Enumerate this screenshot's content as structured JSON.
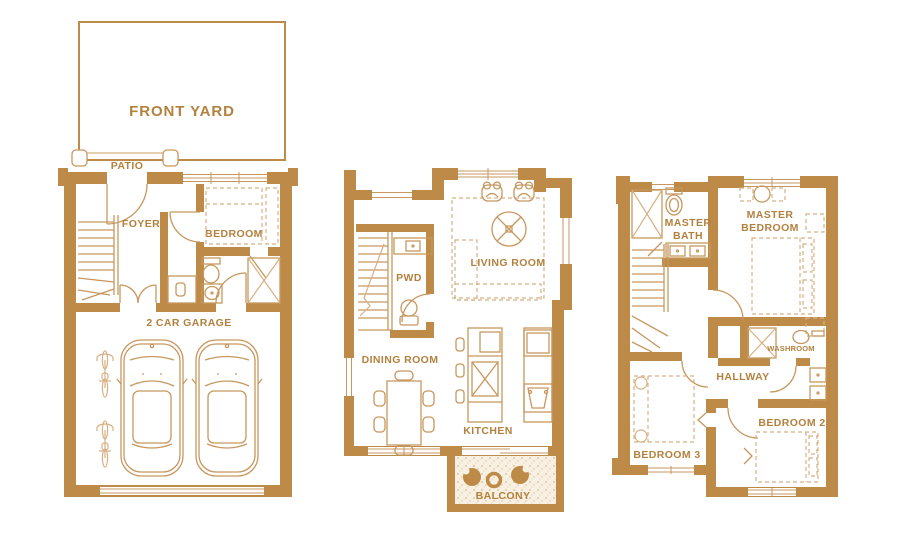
{
  "palette": {
    "wall": "#BE8A48",
    "fixture_line": "#C6975E",
    "furniture_light": "#D7B084",
    "label_text": "#B3813E",
    "balcony_fill": "#F8F1E3",
    "background": "#FFFFFF"
  },
  "plans": [
    {
      "id": "garage-floor",
      "labels": {
        "front_yard": "FRONT YARD",
        "patio": "PATIO",
        "foyer": "FOYER",
        "bedroom": "BEDROOM",
        "garage": "2 CAR GARAGE"
      }
    },
    {
      "id": "main-floor",
      "labels": {
        "pwd": "PWD",
        "living_room": "LIVING ROOM",
        "dining_room": "DINING ROOM",
        "kitchen": "KITCHEN",
        "balcony": "BALCONY"
      }
    },
    {
      "id": "bedroom-floor",
      "labels": {
        "master_bath_line1": "MASTER",
        "master_bath_line2": "BATH",
        "master_bedroom_line1": "MASTER",
        "master_bedroom_line2": "BEDROOM",
        "washroom": "WASHROOM",
        "hallway": "HALLWAY",
        "bedroom3": "BEDROOM 3",
        "bedroom2": "BEDROOM 2"
      }
    }
  ]
}
